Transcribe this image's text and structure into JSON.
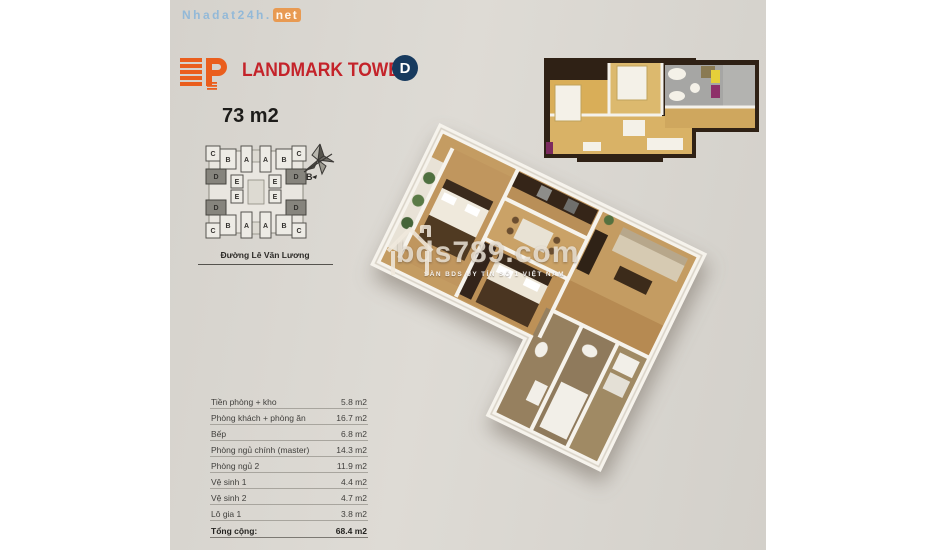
{
  "header": {
    "site_name": "Nhadat24h.",
    "site_suffix": "net"
  },
  "brand": {
    "title": "LANDMARK TOWER",
    "badge": "D",
    "area": "73 m2"
  },
  "site_plan": {
    "street": "Đường Lê Văn Lương",
    "compass": "B",
    "cells": [
      "C",
      "B",
      "A",
      "A",
      "B",
      "C",
      "D",
      "E",
      "E",
      "D",
      "E",
      "E",
      "D",
      "D",
      "C",
      "B",
      "A",
      "A",
      "B",
      "C"
    ]
  },
  "watermark": {
    "text": "bds789.com",
    "subtext": "SÀN BDS UY TÍN SỐ 1 VIỆT NAM"
  },
  "table": {
    "rows": [
      {
        "label": "Tiền phòng + kho",
        "value": "5.8 m2"
      },
      {
        "label": "Phòng khách + phòng ăn",
        "value": "16.7 m2"
      },
      {
        "label": "Bếp",
        "value": "6.8 m2"
      },
      {
        "label": "Phòng ngủ chính (master)",
        "value": "14.3 m2"
      },
      {
        "label": "Phòng ngủ 2",
        "value": "11.9 m2"
      },
      {
        "label": "Vệ sinh 1",
        "value": "4.4 m2"
      },
      {
        "label": "Vệ sinh 2",
        "value": "4.7 m2"
      },
      {
        "label": "Lô gia 1",
        "value": "3.8 m2"
      }
    ],
    "total_label": "Tổng cộng:",
    "total_value": "68.4 m2"
  },
  "colors": {
    "accent_orange": "#ea5e1d",
    "brand_red": "#c4232a",
    "badge_navy": "#173a5e",
    "header_blue": "#93b9d8",
    "floor_tan": "#c49c62",
    "wall_white": "#f6f3ec"
  }
}
